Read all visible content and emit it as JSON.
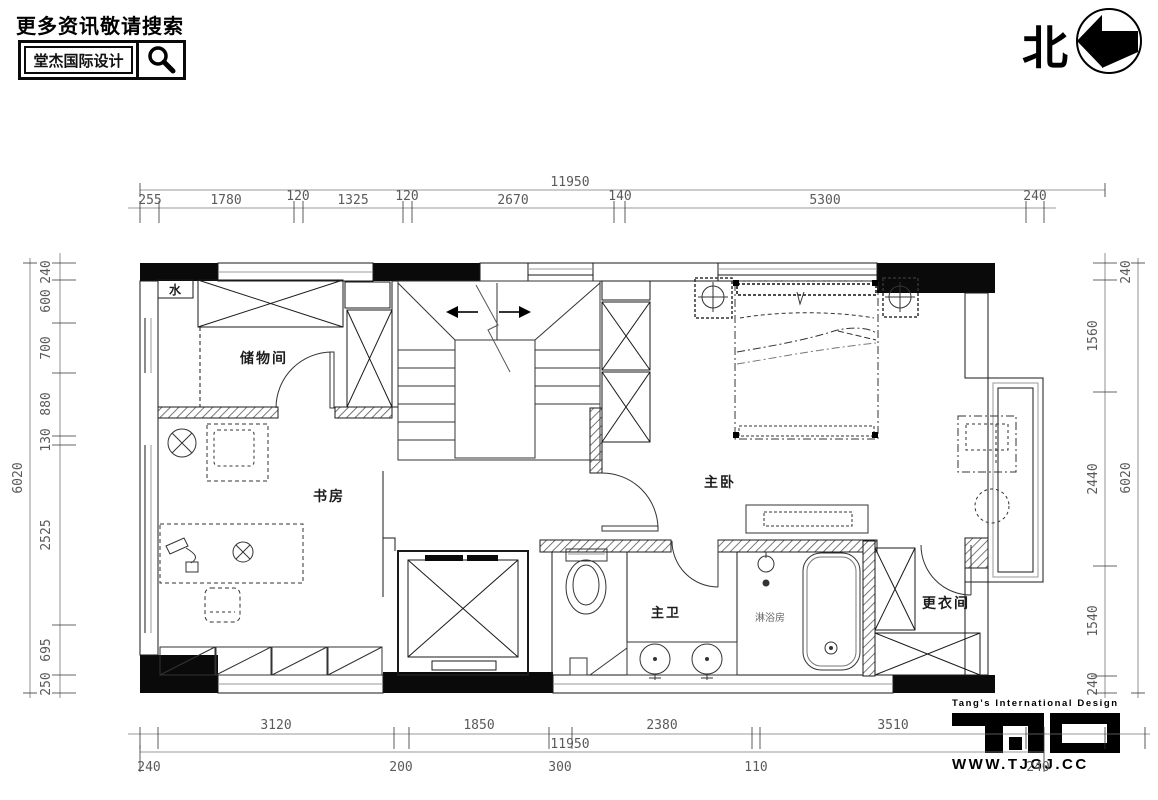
{
  "header": {
    "tagline": "更多资讯敬请搜索",
    "brand": "堂杰国际设计"
  },
  "compass": {
    "north_label": "北"
  },
  "brand_footer": {
    "tagline": "Tang's International Design",
    "website": "WWW.TJGJ.CC"
  },
  "plan": {
    "rooms": {
      "storage": "储物间",
      "study": "书房",
      "master_bedroom": "主卧",
      "master_bath": "主卫",
      "dressing": "更衣间"
    },
    "annotations": {
      "water": "水",
      "shower": "淋浴房"
    }
  },
  "dims": {
    "top": {
      "total": "11950",
      "segments": [
        "255",
        "1780",
        "120",
        "1325",
        "120",
        "2670",
        "140",
        "5300",
        "240"
      ]
    },
    "bottom": {
      "total": "11950",
      "major": [
        "3120",
        "1850",
        "2380",
        "3510"
      ],
      "minor": [
        "240",
        "200",
        "300",
        "110",
        "240"
      ]
    },
    "left": {
      "total": "6020",
      "segments": [
        "240",
        "600",
        "700",
        "880",
        "130",
        "2525",
        "695",
        "250"
      ]
    },
    "right": {
      "total": "6020",
      "segments": [
        "240",
        "1560",
        "2440",
        "1540",
        "240"
      ]
    }
  }
}
